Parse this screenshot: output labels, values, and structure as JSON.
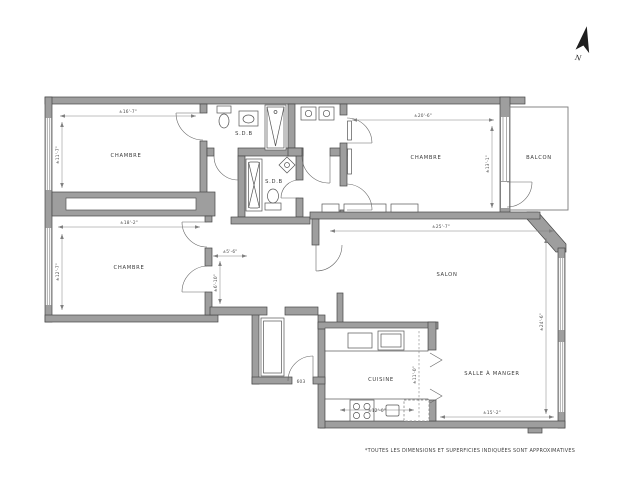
{
  "plan": {
    "note": "*TOUTES LES DIMENSIONS ET SUPERFICIES INDIQUÉES SONT APPROXIMATIVES",
    "north": "N",
    "unit": "603",
    "rooms": {
      "chambre_tl": {
        "label": "CHAMBRE",
        "dim_w": "±16'-7\"",
        "dim_h": "±11'-7\""
      },
      "chambre_bl": {
        "label": "CHAMBRE",
        "dim_w": "±18'-2\"",
        "dim_h": "±12'-7\""
      },
      "chambre_tr": {
        "label": "CHAMBRE",
        "dim_w": "±20'-6\"",
        "dim_h": "±13'-1\""
      },
      "salon": {
        "label": "SALON",
        "dim_w": "±25'-7\"",
        "dim_h": "±24'-6\""
      },
      "cuisine": {
        "label": "CUISINE",
        "dim_w": "±12'-0\"",
        "dim_h": "±11'-0\""
      },
      "salle_a_manger": {
        "label": "SALLE À MANGER",
        "dim_w": "±15'-2\""
      },
      "balcon": {
        "label": "BALCON"
      },
      "sdb_top": {
        "label": "S.D.B"
      },
      "sdb_mid": {
        "label": "S.D.B"
      },
      "hall": {
        "dim_w": "±5'-6\"",
        "dim_h": "±6'-10\""
      }
    },
    "colors": {
      "wall": "#9e9e9e",
      "wall_outline": "#474747",
      "line": "#666666",
      "text": "#3a3a3a",
      "background": "#ffffff"
    }
  }
}
